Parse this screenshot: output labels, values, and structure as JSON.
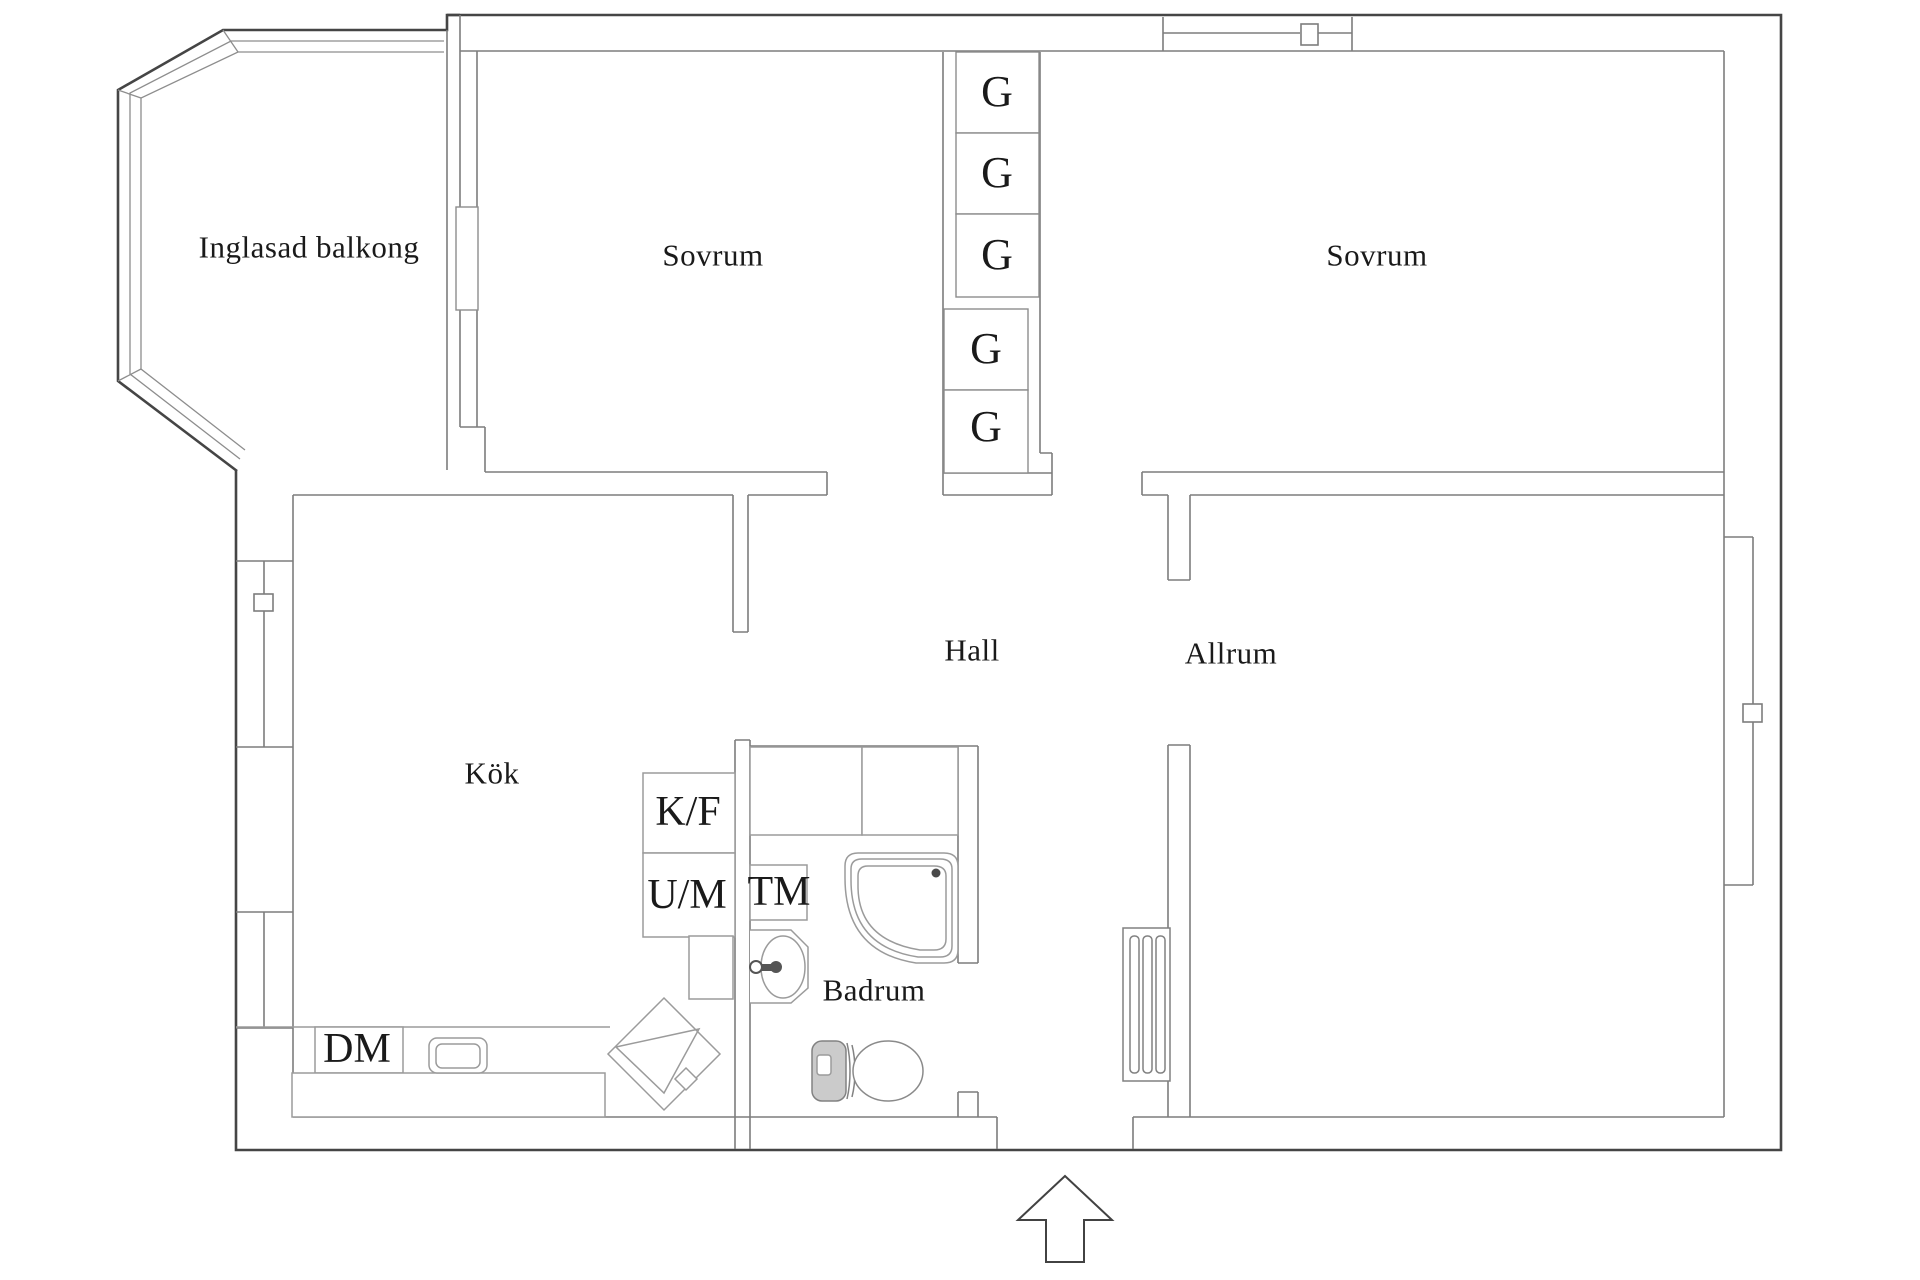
{
  "floorplan": {
    "rooms": {
      "balcony": "Inglasad balkong",
      "bedroom_left": "Sovrum",
      "bedroom_right": "Sovrum",
      "hall": "Hall",
      "kitchen": "Kök",
      "living_room": "Allrum",
      "bathroom": "Badrum"
    },
    "closets": [
      "G",
      "G",
      "G",
      "G",
      "G"
    ],
    "appliances": {
      "fridge_freezer": "K/F",
      "oven_microwave": "U/M",
      "washing_machine": "TM",
      "dishwasher": "DM"
    },
    "colors": {
      "background": "#ffffff",
      "outer_wall": "#454545",
      "inner_wall": "#7d7d7d",
      "fixture_line": "#9b9b9b",
      "text": "#1a1a1a"
    }
  }
}
